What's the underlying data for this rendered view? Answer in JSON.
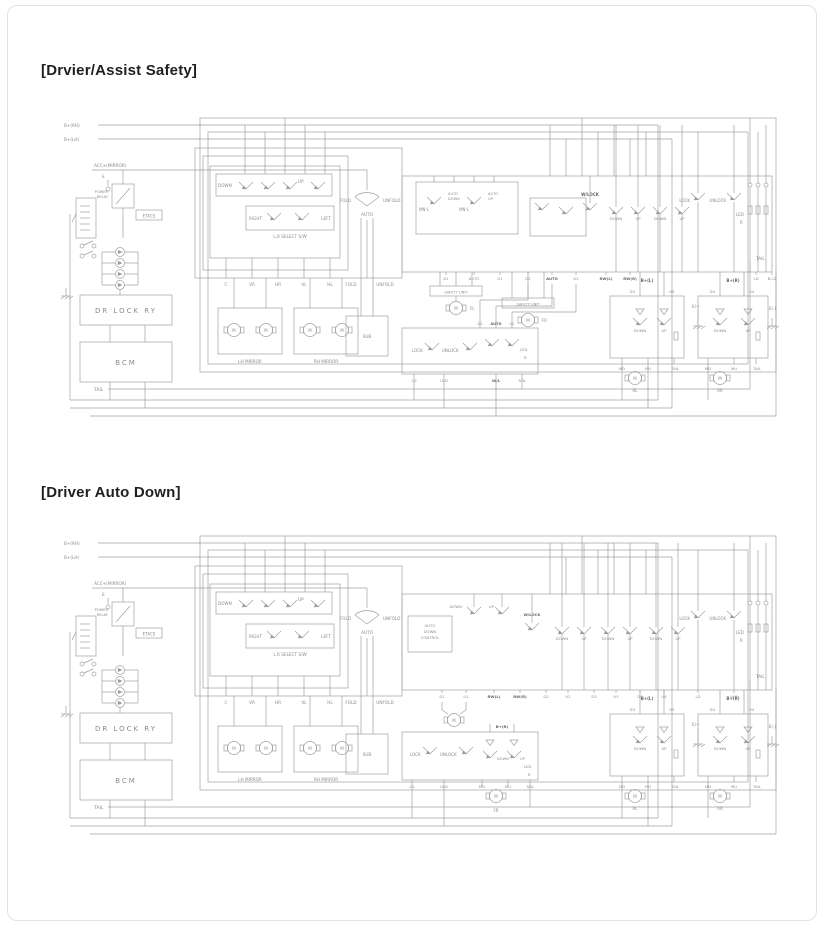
{
  "titles": {
    "d1": "[Drvier/Assist Safety]",
    "d2": "[Driver Auto Down]"
  },
  "colors": {
    "background": "#ffffff",
    "card_border": "#e2e2e2",
    "wire": "#a0a0a0",
    "label_text": "#8b8b8b",
    "title_text": "#1f1f1f"
  },
  "labels": {
    "b_rh": "B+(RH)",
    "b_lh": "B+(LH)",
    "acc": "ACC+(MIRROR)",
    "e": "E",
    "power": "POWER",
    "relay": "RELAY",
    "etacs": "ETACS",
    "dr_lock_ry": "DR LOCK RY",
    "bcm": "BCM",
    "tail": "TAIL",
    "down": "DOWN",
    "up": "UP",
    "right": "RIGHT",
    "left": "LEFT",
    "lr_select": "L,R SELECT S/W",
    "c": "C",
    "vr": "VR",
    "hr": "HR",
    "vl": "VL",
    "hl": "HL",
    "fold": "FOLD",
    "unfold": "UNFOLD",
    "auto": "AUTO",
    "sub": "SUB",
    "lh_mirror": "LH MIRROR",
    "rh_mirror": "RH MIRROR",
    "mnl": "MN'L",
    "control": "CONTROL",
    "d1": "D1",
    "u1": "U1",
    "d2": "D2",
    "u2": "U2",
    "d3": "D3",
    "u3": "U3",
    "d4": "D4",
    "u4": "U4",
    "safety_unit": "SAFETY UNIT",
    "m": "M",
    "fl": "FL",
    "fr": "FR",
    "rl": "RL",
    "rr": "RR",
    "lock": "LOCK",
    "unlock": "UNLOCK",
    "ld": "LD",
    "uld": "ULD",
    "wl": "W/L",
    "wlock": "W/LOCK",
    "led": "LED",
    "r": "R",
    "rw_l": "RW(L)",
    "rw_r": "RW(R)",
    "bld": "B.LD",
    "bp_l": "B+(L)",
    "bp_r": "B+(R)",
    "md": "MD",
    "mu": "MU",
    "e_minus": "E(-)"
  }
}
